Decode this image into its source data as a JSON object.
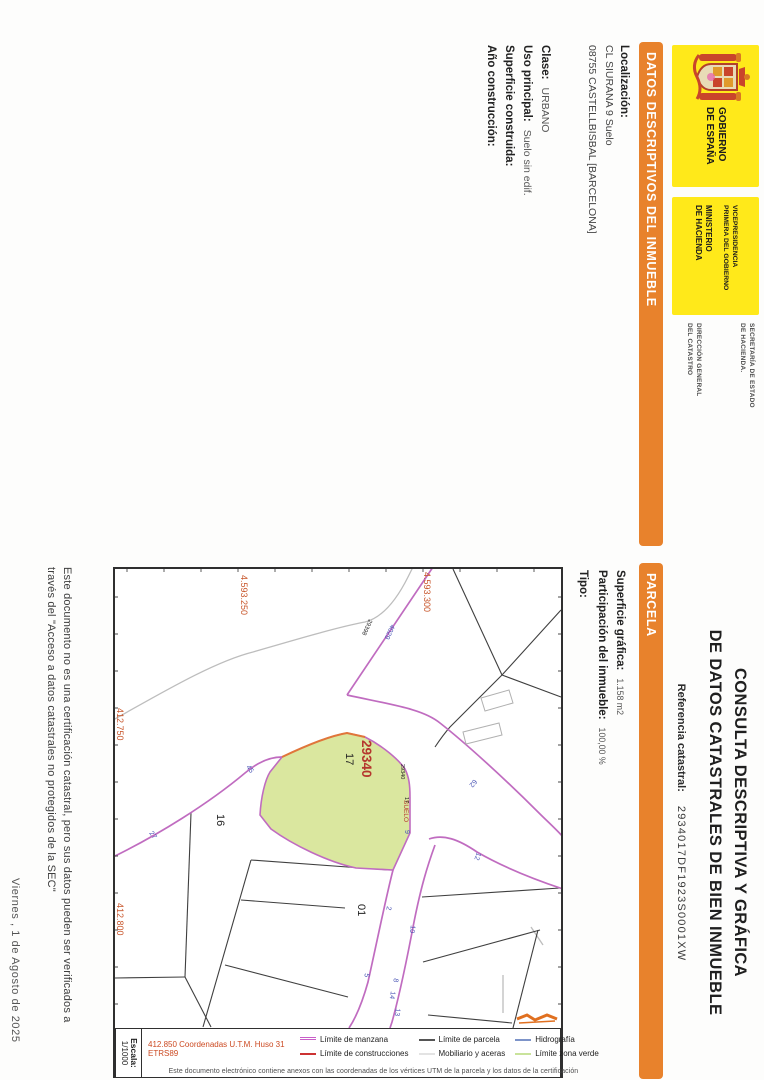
{
  "header": {
    "gobierno_l1": "GOBIERNO",
    "gobierno_l2": "DE ESPAÑA",
    "vice_l1": "VICEPRESIDENCIA",
    "vice_l2": "PRIMERA DEL GOBIERNO",
    "min_l1": "MINISTERIO",
    "min_l2": "DE HACIENDA",
    "sec_l1": "SECRETARÍA DE ESTADO",
    "sec_l2": "DE HACIENDA.",
    "dir_l1": "DIRECCIÓN GENERAL",
    "dir_l2": "DEL CATASTRO",
    "title_line1": "CONSULTA DESCRIPTIVA Y GRÁFICA",
    "title_line2": "DE DATOS CATASTRALES DE BIEN INMUEBLE",
    "ref_label": "Referencia catastral:",
    "ref_value": "2934017DF1923S0001XW"
  },
  "datos": {
    "section_title": "DATOS DESCRIPTIVOS DEL INMUEBLE",
    "localizacion_label": "Localización:",
    "address_line1": "CL SIURANA 9 Suelo",
    "address_line2": "08755 CASTELLBISBAL [BARCELONA]",
    "clase_label": "Clase:",
    "clase_value": "URBANO",
    "uso_label": "Uso principal:",
    "uso_value": "Suelo sin edif.",
    "superficie_label": "Superficie construida:",
    "anio_label": "Año construcción:"
  },
  "parcela": {
    "section_title": "PARCELA",
    "superficie_label": "Superficie gráfica:",
    "superficie_value": "1.158 m2",
    "participacion_label": "Participación del inmueble:",
    "participacion_value": "100,00 %",
    "tipo_label": "Tipo:"
  },
  "map": {
    "labels": {
      "northing": [
        "4.593.250",
        "4.593.300"
      ],
      "easting": [
        "412.750",
        "412.800"
      ],
      "manzana_red": "29340",
      "parcel_number": "17",
      "suelo": "SUELO",
      "manzana_small": "29340",
      "parcel_small": "17",
      "neighbor_manzana": "29398",
      "parcel_16": "16",
      "parcel_01": "01",
      "street_numbers": [
        "45",
        "27",
        "9",
        "4029",
        "62",
        "12",
        "2",
        "10",
        "5",
        "8",
        "14",
        "13"
      ]
    },
    "colors": {
      "parcel_fill": "#DAE79F",
      "road_edge": "#C06CC0",
      "coordinate_text": "#C8562B",
      "manzana_text": "#B5372E",
      "street_text": "#4A55B5"
    }
  },
  "legend": {
    "escala_label": "Escala:",
    "escala_value": "1/1000",
    "coords_note": "412.850 Coordenadas U.T.M. Huso 31 ETRS89",
    "items": [
      {
        "label": "Límite de manzana",
        "color": "#C85FC8"
      },
      {
        "label": "Límite de construcciones",
        "color": "#CC3333"
      },
      {
        "label": "Límite de parcela",
        "color": "#555555"
      },
      {
        "label": "Mobiliario y aceras",
        "color": "#E3E3E3"
      },
      {
        "label": "Hidrografía",
        "color": "#7D94C9"
      },
      {
        "label": "Límite zona verde",
        "color": "#C9E39B"
      }
    ],
    "note": "Este documento electrónico contiene anexos con las coordenadas de los vértices UTM de la parcela y los datos de la certificación"
  },
  "footer": {
    "disclaimer_line1": "Este documento no es una certificación catastral, pero sus datos pueden ser verificados a",
    "disclaimer_line2": "través del \"Acceso a datos catastrales no protegidos de la SEC\"",
    "date": "Viernes , 1 de Agosto de 2025"
  }
}
